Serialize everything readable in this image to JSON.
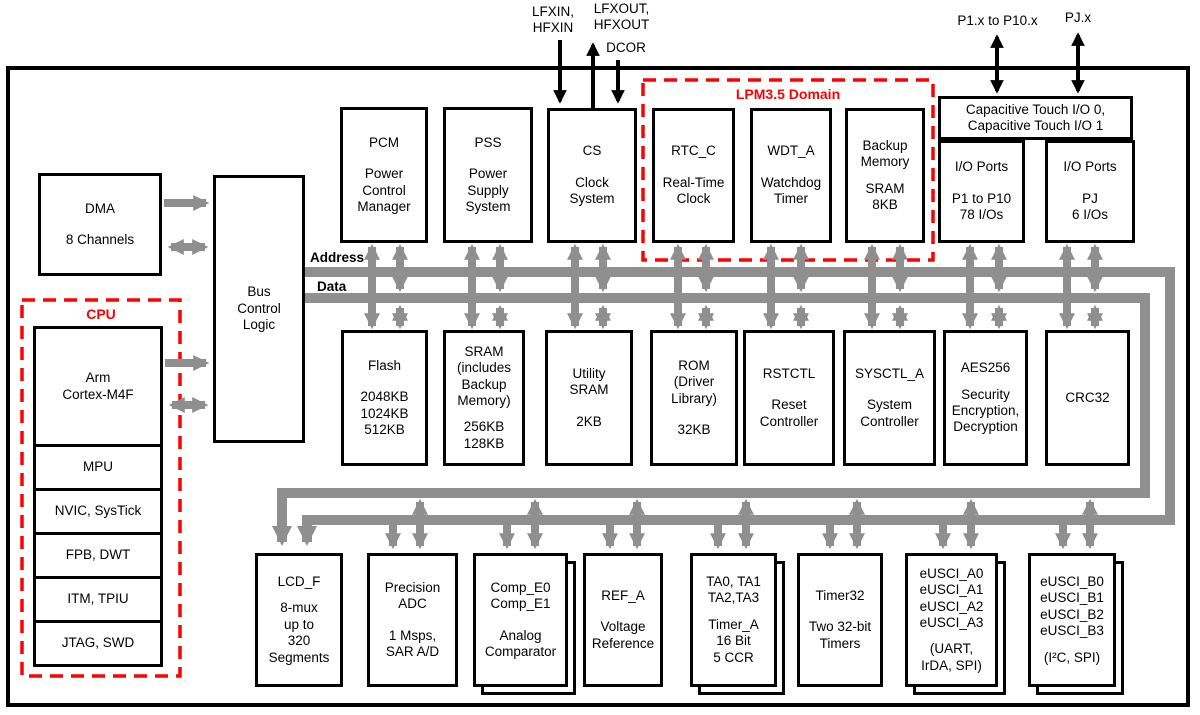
{
  "diagram_title": "Microcontroller functional block diagram",
  "colors": {
    "accent_red": "#ff0000",
    "bus_gray": "#8f8f8f",
    "line_black": "#000000",
    "background": "#ffffff"
  },
  "regions": {
    "cpu": "CPU",
    "lpm": "LPM3.5 Domain"
  },
  "bus": {
    "address": "Address",
    "data": "Data"
  },
  "pins": {
    "lfxin": "LFXIN,\nHFXIN",
    "lfxout": "LFXOUT,\nHFXOUT",
    "dcor": "DCOR",
    "p1": "P1.x to P10.x",
    "pj": "PJ.x"
  },
  "blocks": {
    "dma": {
      "title": "DMA",
      "sub": "8 Channels"
    },
    "bcl": {
      "title": "Bus\nControl\nLogic"
    },
    "pcm": {
      "title": "PCM",
      "sub": "Power\nControl\nManager"
    },
    "pss": {
      "title": "PSS",
      "sub": "Power\nSupply\nSystem"
    },
    "cs": {
      "title": "CS",
      "sub": "Clock\nSystem"
    },
    "rtc": {
      "title": "RTC_C",
      "sub": "Real-Time\nClock"
    },
    "wdt": {
      "title": "WDT_A",
      "sub": "Watchdog\nTimer"
    },
    "backup": {
      "title": "Backup\nMemory",
      "sub": "SRAM\n8KB"
    },
    "captouch": {
      "title": "Capacitive Touch I/O 0,\nCapacitive Touch I/O 1"
    },
    "io1": {
      "title": "I/O Ports",
      "sub": "P1 to P10\n78 I/Os"
    },
    "io2": {
      "title": "I/O Ports",
      "sub": "PJ\n6 I/Os"
    },
    "flash": {
      "title": "Flash",
      "sub": "2048KB\n1024KB\n512KB"
    },
    "sram": {
      "title": "SRAM\n(includes\nBackup\nMemory)",
      "sub": "256KB\n128KB"
    },
    "usram": {
      "title": "Utility\nSRAM",
      "sub": "2KB"
    },
    "rom": {
      "title": "ROM\n(Driver\nLibrary)",
      "sub": "32KB"
    },
    "rstctl": {
      "title": "RSTCTL",
      "sub": "Reset\nController"
    },
    "sysctl": {
      "title": "SYSCTL_A",
      "sub": "System\nController"
    },
    "aes": {
      "title": "AES256",
      "sub": "Security\nEncryption,\nDecryption"
    },
    "crc": {
      "title": "CRC32"
    },
    "lcd": {
      "title": "LCD_F",
      "sub": "8-mux\nup to\n320\nSegments"
    },
    "adc": {
      "title": "Precision\nADC",
      "sub": "1 Msps,\nSAR A/D"
    },
    "comp": {
      "title": "Comp_E0\nComp_E1",
      "sub": "Analog\nComparator"
    },
    "ref": {
      "title": "REF_A",
      "sub": "Voltage\nReference"
    },
    "ta": {
      "title": "TA0, TA1\nTA2,TA3",
      "sub": "Timer_A\n16 Bit\n5 CCR"
    },
    "t32": {
      "title": "Timer32",
      "sub": "Two 32-bit\nTimers"
    },
    "ea": {
      "title": "eUSCI_A0\neUSCI_A1\neUSCI_A2\neUSCI_A3",
      "sub": "(UART,\nIrDA, SPI)"
    },
    "eb": {
      "title": "eUSCI_B0\neUSCI_B1\neUSCI_B2\neUSCI_B3",
      "sub": "(I²C, SPI)"
    }
  },
  "cpu_cells": [
    "Arm\nCortex-M4F",
    "MPU",
    "NVIC, SysTick",
    "FPB, DWT",
    "ITM, TPIU",
    "JTAG, SWD"
  ]
}
